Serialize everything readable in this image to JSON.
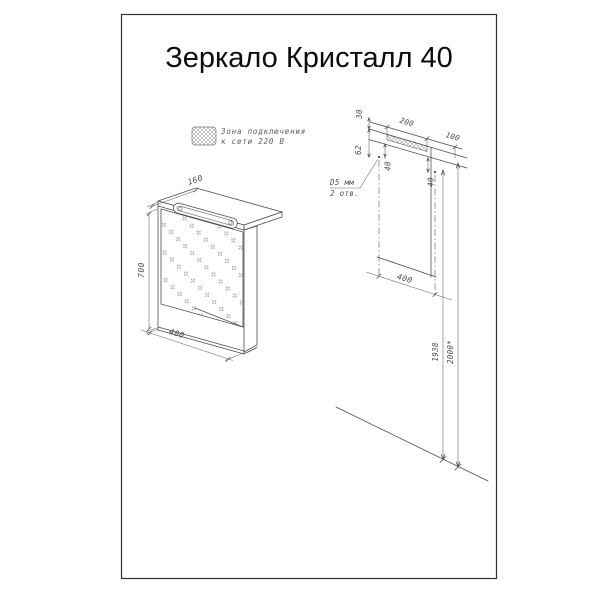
{
  "title": "Зеркало Кристалл 40",
  "legend": {
    "line1": "Зона подключения",
    "line2": "к сети 220 В"
  },
  "cabinet_view": {
    "depth_mm": "160",
    "height_mm": "700",
    "width_mm": "400"
  },
  "mounting_view": {
    "top_offset_mm": "30",
    "zone_width_mm": "200",
    "zone_side_offset_mm": "100",
    "hole_top_offset_mm": "62",
    "hole_inset_left_mm": "40",
    "hole_inset_right_mm": "40",
    "holes_note_line1": "D5 мм",
    "holes_note_line2": "2 отв.",
    "holes_spacing_mm": "400",
    "holes_height_mm": "1938",
    "overall_height_mm": "2000*"
  },
  "colors": {
    "line": "#4d4d4d",
    "title": "#0d0d0d",
    "frame": "#333333",
    "background": "#ffffff"
  }
}
